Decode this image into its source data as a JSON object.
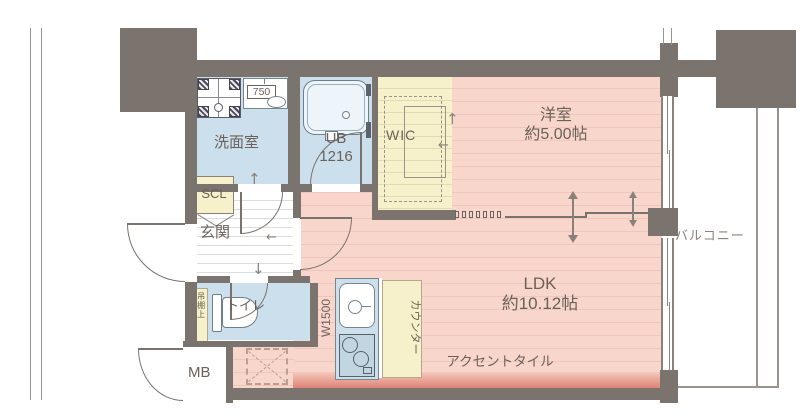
{
  "plan": {
    "title": "1LDK apartment floor plan",
    "rooms": {
      "western_room": {
        "name": "洋室",
        "size": "約5.00帖"
      },
      "ldk": {
        "name": "LDK",
        "size": "約10.12帖"
      },
      "washroom": {
        "name": "洗面室"
      },
      "bath": {
        "name": "UB",
        "size": "1216"
      },
      "wic": {
        "name": "WIC"
      },
      "entrance": {
        "name": "玄関"
      },
      "toilet": {
        "name": "トイレ"
      },
      "balcony": {
        "name": "バルコニー"
      },
      "shoe_closet": {
        "name": "SCL"
      },
      "meter_box": {
        "name": "MB"
      }
    },
    "annotations": {
      "accent_tile": "アクセントタイル",
      "counter": "カウンター",
      "kitchen_width": "W1500",
      "laundry_counter_width": "750",
      "toilet_shelf": "吊棚上"
    },
    "colors": {
      "wall": "#7b736d",
      "room_pink": "#f8d6cb",
      "room_blue": "#cbdfec",
      "room_yellow": "#f6f1cb",
      "accent_tile": "#dd8276",
      "label_text": "#6b6159",
      "line": "#8a837c"
    }
  }
}
